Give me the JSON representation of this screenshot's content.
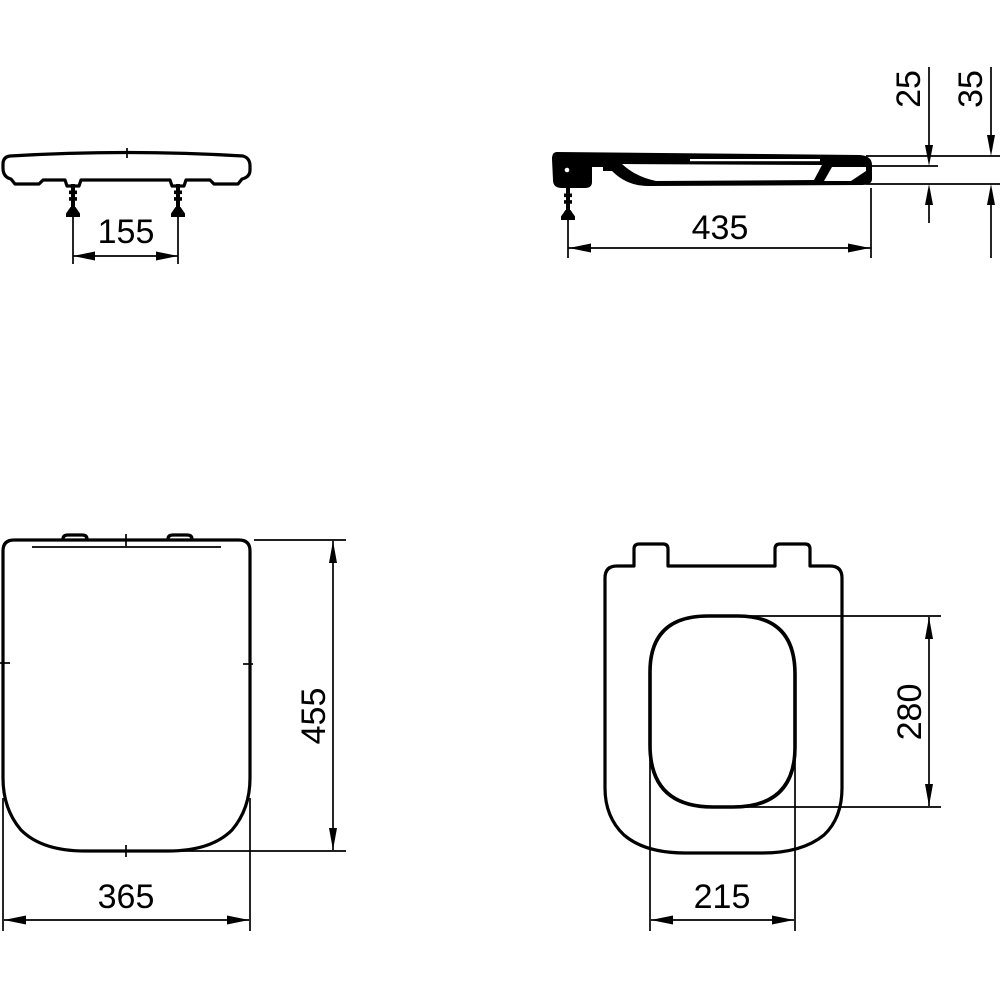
{
  "drawing": {
    "background_color": "#ffffff",
    "line_color": "#000000",
    "views": {
      "front": {
        "hinge_spacing_mm": "155"
      },
      "side": {
        "length_mm": "435",
        "ring_thickness_mm": "25",
        "total_height_mm": "35"
      },
      "cover_plan": {
        "width_mm": "365",
        "depth_mm": "455"
      },
      "ring_plan": {
        "opening_width_mm": "215",
        "opening_depth_mm": "280"
      }
    }
  }
}
